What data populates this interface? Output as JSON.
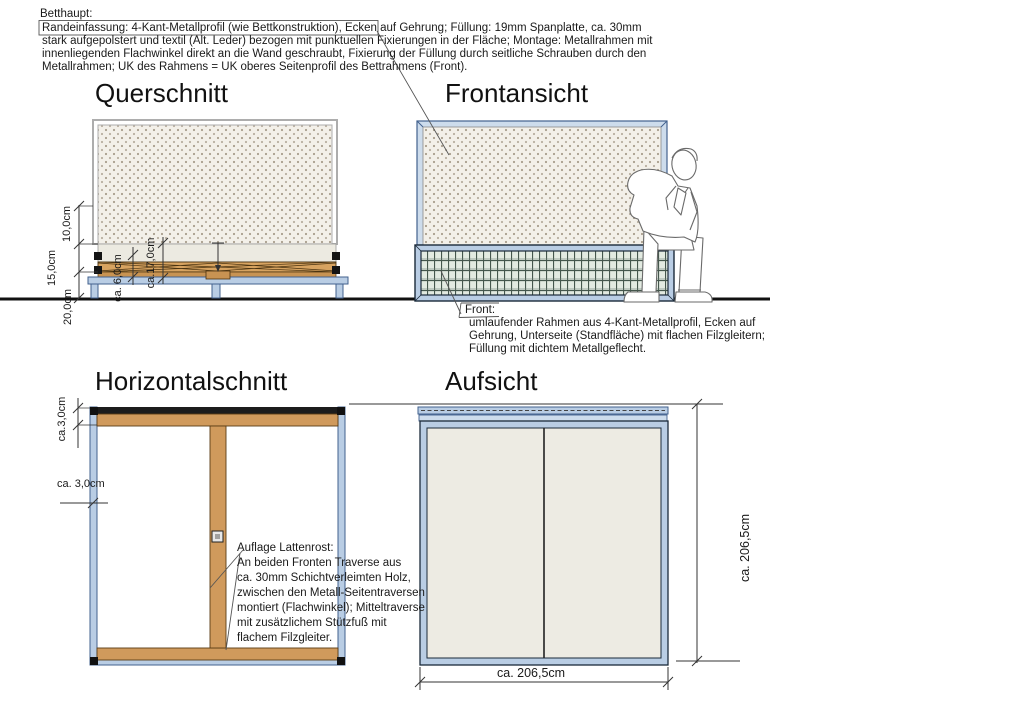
{
  "header": {
    "title": "Betthaupt:",
    "boxed": "Randeinfassung: 4-Kant-Metallprofil (wie Bettkonstruktion)",
    "line1_rest": ", Ecken auf Gehrung; Füllung: 19mm Spanplatte, ca. 30mm",
    "line2": "stark aufgepolstert und textil (Alt. Leder) bezogen mit punktuellen Fixierungen in der Fläche; Montage: Metallrahmen mit",
    "line3": "innenliegenden Flachwinkel direkt an die Wand geschraubt, Fixierung der Füllung durch seitliche Schrauben durch den",
    "line4": "Metallrahmen; UK des Rahmens = UK oberes Seitenprofil des Bettrahmens (Front)."
  },
  "views": {
    "querschnitt": {
      "title": "Querschnitt",
      "dims": {
        "d10": "10,0cm",
        "d15": "15,0cm",
        "d20": "20,0cm",
        "d6": "ca. 6,0cm",
        "d17": "ca.17,0cm"
      }
    },
    "frontansicht": {
      "title": "Frontansicht",
      "front_note": {
        "label": "Front:",
        "line1": "umlaufender Rahmen aus 4-Kant-Metallprofil, Ecken auf",
        "line2": "Gehrung, Unterseite (Standfläche) mit flachen Filzgleitern;",
        "line3": "Füllung mit dichtem Metallgeflecht."
      }
    },
    "horizontalschnitt": {
      "title": "Horizontalschnitt",
      "dims": {
        "d3_top": "ca.3,0cm",
        "d3_side": "ca. 3,0cm"
      },
      "auflage_note": {
        "label": "Auflage Lattenrost:",
        "line1": "An beiden Fronten Traverse aus",
        "line2": "ca. 30mm Schichtverleimten Holz,",
        "line3": "zwischen den Metall-Seitentraversen",
        "line4": "montiert (Flachwinkel); Mitteltraverse",
        "line5": "mit zusätzlichem Stützfuß mit",
        "line6": "flachem Filzgleiter."
      }
    },
    "aufsicht": {
      "title": "Aufsicht",
      "dims": {
        "width": "ca. 206,5cm",
        "height": "ca. 206,5cm"
      }
    }
  },
  "colors": {
    "metal_frame_blue": "#b9cde4",
    "metal_frame_blue_dark": "#42618e",
    "wood_tan": "#d09a5c",
    "mesh_green_bg": "#e2eae1",
    "mesh_grid_line": "#44564c",
    "upholstery_bg": "#f3f0e9",
    "upholstery_dot": "#a89e8d",
    "line_dark": "#1a1a1a"
  }
}
